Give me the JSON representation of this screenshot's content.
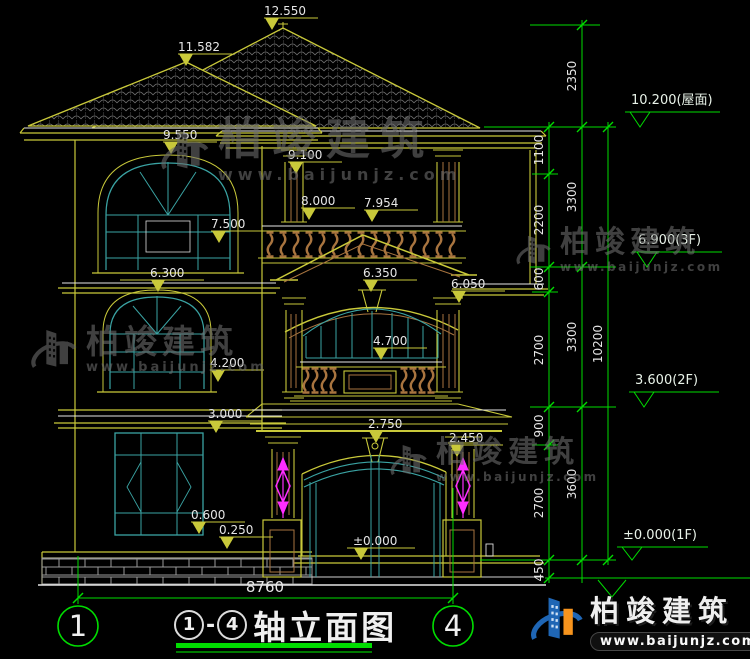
{
  "drawing": {
    "title_label": "轴立面图",
    "title_separator": "-",
    "axis_start": "1",
    "axis_end": "4",
    "overall_width_mm": "8760"
  },
  "level_marks": [
    {
      "label": "12.550"
    },
    {
      "label": "11.582"
    },
    {
      "label": "9.550"
    },
    {
      "label": "9.100"
    },
    {
      "label": "8.000"
    },
    {
      "label": "7.954"
    },
    {
      "label": "7.500"
    },
    {
      "label": "6.300"
    },
    {
      "label": "6.350"
    },
    {
      "label": "6.050"
    },
    {
      "label": "4.700"
    },
    {
      "label": "4.200"
    },
    {
      "label": "3.000"
    },
    {
      "label": "2.750"
    },
    {
      "label": "2.450"
    },
    {
      "label": "0.600"
    },
    {
      "label": "0.250"
    },
    {
      "label": "±0.000"
    }
  ],
  "right_panel": {
    "floor_marks": [
      {
        "label": "10.200(屋面)"
      },
      {
        "label": "6.900(3F)"
      },
      {
        "label": "3.600(2F)"
      },
      {
        "label": "±0.000(1F)"
      }
    ],
    "chain_inner": [
      "1100",
      "2200",
      "600",
      "2700",
      "900",
      "2700",
      "450"
    ],
    "chain_middle": [
      "2350",
      "3300",
      "3300",
      "3600"
    ],
    "chain_outer": [
      "10200"
    ]
  },
  "watermark": {
    "brand": "柏竣建筑",
    "url": "www.baijunjz.com"
  },
  "footer_logo": {
    "brand": "柏竣建筑",
    "url": "www.baijunjz.com"
  },
  "colors": {
    "annotation_green": "#00dd00",
    "line_yellow": "#c9c93a",
    "line_brown": "#a8743f",
    "line_cyan": "#3aa3a3",
    "line_white": "#e6e6e6",
    "accent_magenta": "#ff2dff",
    "logo_blue": "#1f66b5",
    "logo_orange": "#f7941d"
  }
}
